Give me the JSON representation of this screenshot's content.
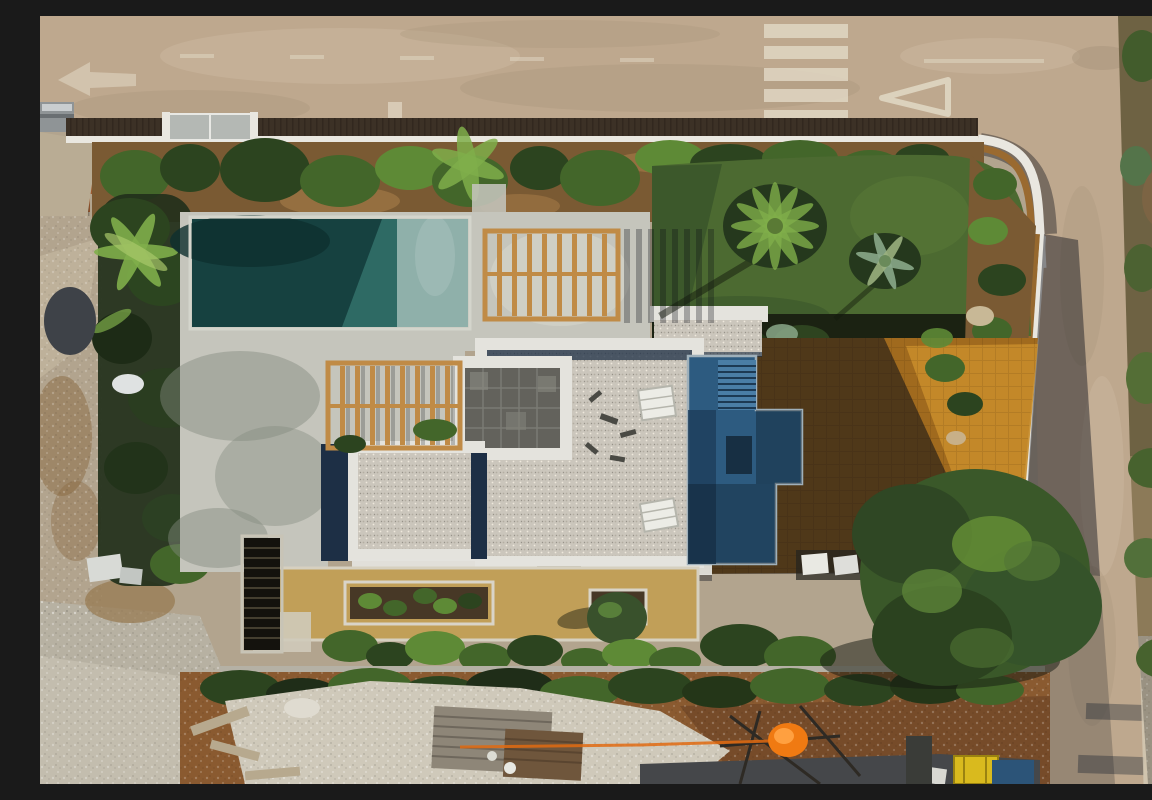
{
  "scene": {
    "type": "aerial-drone-photograph",
    "description": "Aerial top-down drone photograph of a modern flat-roofed villa under construction: turquoise rectangular swimming pool with concrete deck and two timber pergolas, white-edged gravel roof terraces, a navy-blue roof deck with exterior stairs, amber paved side terrace, green lawn with palm trees, landscaped planting beds, a perimeter road with zebra crossing and yield markings at top, a side road on the right, and construction rubble, timber and a yellow skip at the bottom of the plot.",
    "features": [
      "concrete road with dashed center line",
      "zebra crossing",
      "yield triangle road marking",
      "white road arrow marking",
      "dark wooden perimeter fence on white wall",
      "curved white corner wall",
      "entrance gate",
      "roadside hedge and garden bed",
      "rectangular swimming pool, partly shaded",
      "concrete pool deck",
      "timber pergola near pool",
      "timber pergola over patio",
      "slate-tiled roof section",
      "white gravel roof terraces with parapets",
      "navy roof terrace with staircase",
      "roof skylights",
      "amber paver terrace in building shadow",
      "lawn with fan palms",
      "sunken vegetable planters and olive tree",
      "exterior concrete stairwell",
      "large pine tree overhanging side road",
      "roadside scrubland on right edge",
      "white rubble heap and construction timber",
      "orange safety mesh fence",
      "yellow skip and blue tarp",
      "rocky undeveloped ground on left"
    ]
  },
  "colors": {
    "road": "#bea88e",
    "road_light": "#ccb89f",
    "road_dark": "#a8947c",
    "road_marking": "#e2d9c6",
    "curb": "#d5cbb6",
    "fence_wood": "#3c3126",
    "wall_white": "#e9e7e0",
    "gate_gray": "#b4b8b4",
    "soil": "#7a5a33",
    "soil_light": "#9c7443",
    "hedge_dark": "#2c441f",
    "hedge_mid": "#43662a",
    "hedge_light": "#5e8a36",
    "lawn": "#4c6a31",
    "lawn_shade": "#36512a",
    "palm_dark": "#25381d",
    "palm_light": "#7fae4a",
    "pool_dark": "#164140",
    "pool_mid": "#2e6a64",
    "pool_light": "#8fb0aa",
    "deck": "#c5c5bc",
    "deck_shadow": "#83897e",
    "pergola_wood": "#c08b46",
    "gravel": "#cbc6bc",
    "slate": "#63625c",
    "parapet": "#e4e3dd",
    "navy": "#1d2f45",
    "blue_terrace": "#2d5b80",
    "blue_terrace_shade": "#1e405d",
    "stair_blue": "#4a7ea6",
    "paver_amber": "#a06a1e",
    "paver_lit": "#c68c2a",
    "sand_terrace": "#c19f58",
    "dirt": "#8a5a30",
    "dirt_dark": "#6e4526",
    "rubble_light": "#cfc9ba",
    "rubble_gray": "#b7b1a2",
    "rock_left": "#b2a48e",
    "tree_green": "#3a5829",
    "tree_light": "#679136",
    "orange": "#f07a12",
    "yellow": "#d9ba1e",
    "tarp_blue": "#2c5478",
    "tile_stack": "#9c5a30",
    "asphalt_dark": "#45474a",
    "shed_gray": "#8f9496"
  }
}
